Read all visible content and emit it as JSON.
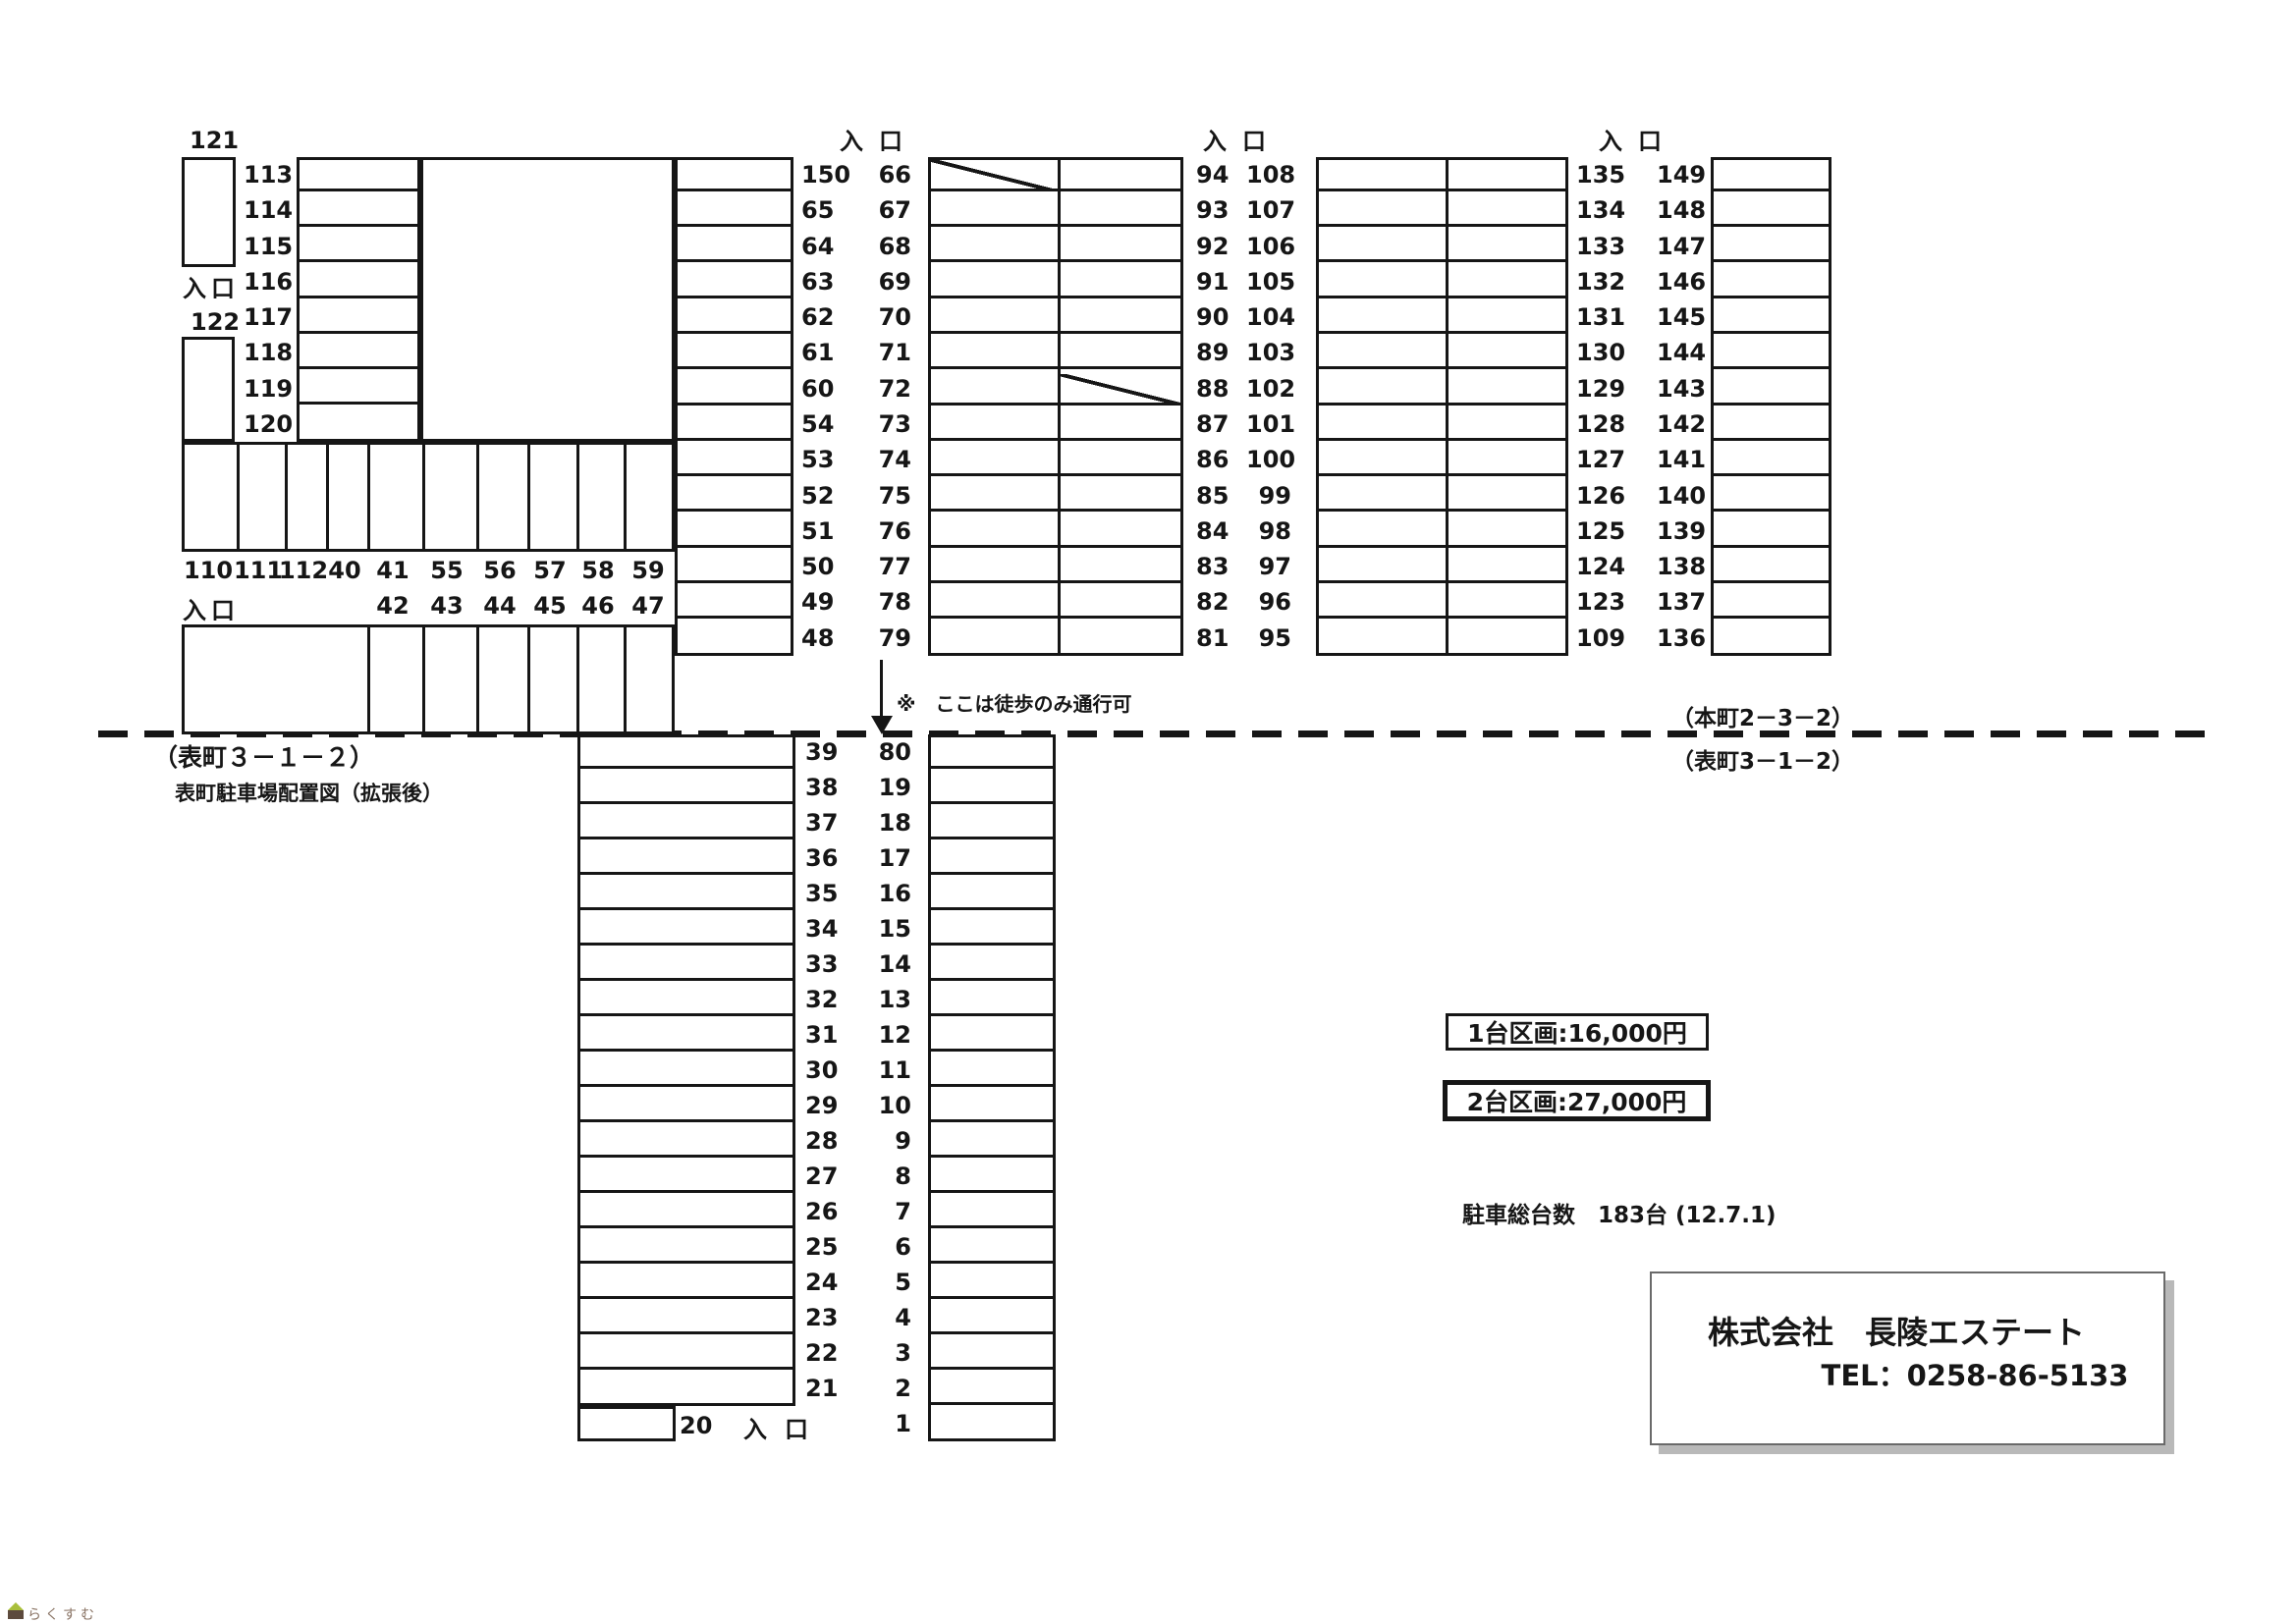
{
  "labels": {
    "entrance": "入口"
  },
  "top": {
    "stall_121": "121",
    "stall_122": "122",
    "left_column_labels": [
      "113",
      "114",
      "115",
      "116",
      "117",
      "118",
      "119",
      "120"
    ],
    "clinic_name": "鞍立歯科医院",
    "band1_labels": [
      "110",
      "111",
      "112",
      "40",
      "41",
      "55",
      "56",
      "57",
      "58",
      "59"
    ],
    "band2_labels": [
      "42",
      "43",
      "44",
      "45",
      "46",
      "47"
    ],
    "police_line1": "表町派出所跡、",
    "police_line2": "（本町2－3－2）",
    "col1_labels": [
      "150",
      "65",
      "64",
      "63",
      "62",
      "61",
      "60",
      "54",
      "53",
      "52",
      "51",
      "50",
      "49",
      "48"
    ],
    "col2_left_labels": [
      "66",
      "67",
      "68",
      "69",
      "70",
      "71",
      "72",
      "73",
      "74",
      "75",
      "76",
      "77",
      "78",
      "79"
    ],
    "col2_right_labels": [
      "94",
      "93",
      "92",
      "91",
      "90",
      "89",
      "88",
      "87",
      "86",
      "85",
      "84",
      "83",
      "82",
      "81"
    ],
    "block3_left_labels": [
      "108",
      "107",
      "106",
      "105",
      "104",
      "103",
      "102",
      "101",
      "100",
      "99",
      "98",
      "97",
      "96",
      "95"
    ],
    "block3_right_labels": [
      "135",
      "134",
      "133",
      "132",
      "131",
      "130",
      "129",
      "128",
      "127",
      "126",
      "125",
      "124",
      "123",
      "109"
    ],
    "block4_labels": [
      "149",
      "148",
      "147",
      "146",
      "145",
      "144",
      "143",
      "142",
      "141",
      "140",
      "139",
      "138",
      "137",
      "136"
    ]
  },
  "road": {
    "walk_note": "※　ここは徒歩のみ通行可",
    "addr_upper_right": "（本町2－3－2）",
    "addr_lower_right": "（表町3－1－2）",
    "addr_lower_left": "（表町３－１－２）",
    "map_title": "表町駐車場配置図（拡張後）"
  },
  "bottom": {
    "left_labels": [
      "39",
      "38",
      "37",
      "36",
      "35",
      "34",
      "33",
      "32",
      "31",
      "30",
      "29",
      "28",
      "27",
      "26",
      "25",
      "24",
      "23",
      "22",
      "21"
    ],
    "stall_20": "20",
    "right_labels": [
      "80",
      "19",
      "18",
      "17",
      "16",
      "15",
      "14",
      "13",
      "12",
      "11",
      "10",
      "9",
      "8",
      "7",
      "6",
      "5",
      "4",
      "3",
      "2",
      "1"
    ]
  },
  "info": {
    "price_single": "1台区画:16,000円",
    "price_double": "2台区画:27,000円",
    "total_count": "駐車総台数　183台 (12.7.1)",
    "company_name": "株式会社　長陵エステート",
    "company_tel": "TEL：0258-86-5133"
  },
  "logo": {
    "text": "らくすむ"
  }
}
